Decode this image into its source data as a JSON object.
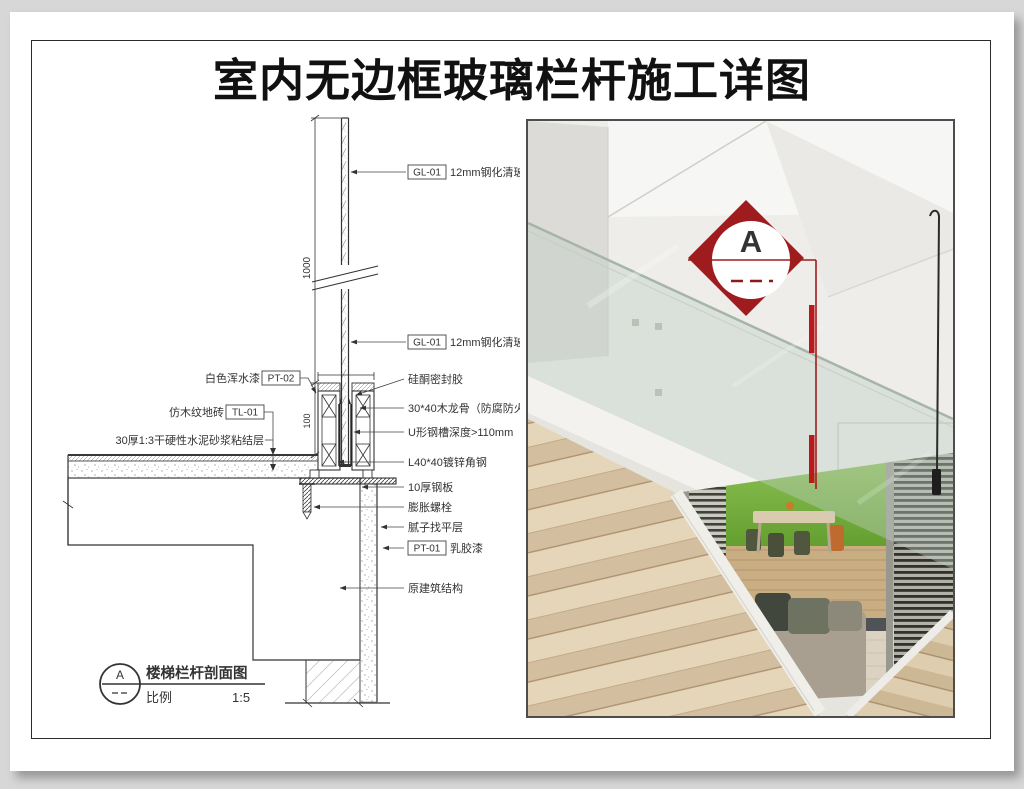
{
  "page": {
    "title": "室内无边框玻璃栏杆施工详图"
  },
  "drawing": {
    "dims": {
      "height": "1000",
      "base": "100"
    },
    "glass_tag": "GL-01",
    "glass_label": "12mm钢化清玻",
    "callouts": {
      "pt02_label": "白色浑水漆",
      "pt02_tag": "PT-02",
      "tl01_label": "仿木纹地砖",
      "tl01_tag": "TL-01",
      "mortar": "30厚1:3干硬性水泥砂浆粘结层",
      "sealant": "硅酮密封胶",
      "joist": "30*40木龙骨（防腐防火处理）",
      "channel": "U形钢槽深度>110mm",
      "angle": "L40*40镀锌角钢",
      "plate": "10厚钢板",
      "bolt": "膨胀螺栓",
      "leveling": "腻子找平层",
      "pt01_tag": "PT-01",
      "pt01_label": "乳胶漆",
      "structure": "原建筑结构"
    },
    "title_block": {
      "marker": "A",
      "name": "楼梯栏杆剖面图",
      "scale_label": "比例",
      "scale_value": "1:5"
    }
  },
  "photo": {
    "marker": "A",
    "accent_red": "#9e1c1e",
    "bar_red": "#bc1a1a"
  }
}
